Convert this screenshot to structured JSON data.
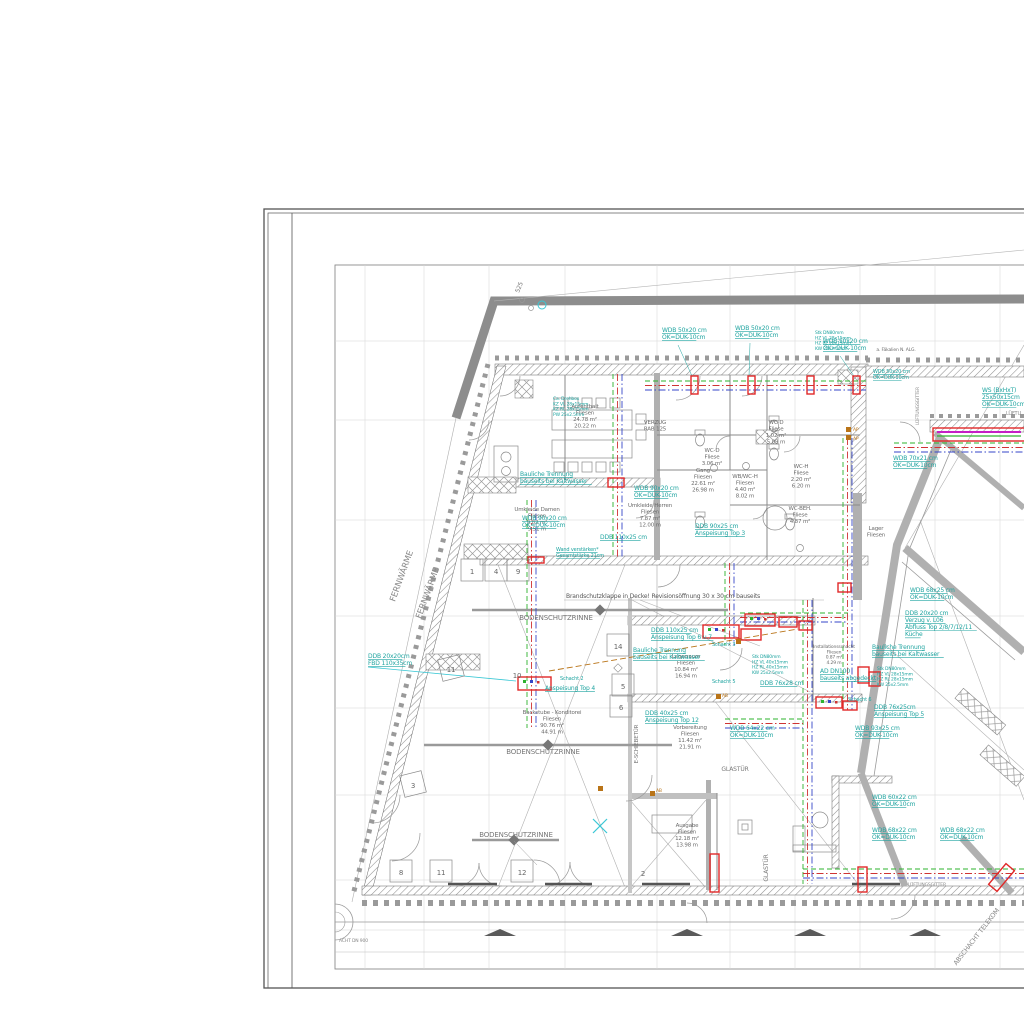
{
  "drawing": {
    "palette": {
      "annotation_teal": "#1fa4a0",
      "marker_red": "#e02828",
      "pipe_green": "#2db32d",
      "pipe_red": "#cf3333",
      "pipe_blue": "#3546c8",
      "pipe_orange": "#b97418",
      "magenta": "#c520c5",
      "wall_gray": "#b0b0b0",
      "band_gray": "#8d8d8d",
      "text_gray": "#6b6b6b",
      "cyan_light": "#39c7d4"
    },
    "annotations": [
      {
        "t": "WDB 50x20 cm\nOK=DUK-10cm",
        "x": 662,
        "y": 332,
        "u": 1
      },
      {
        "t": "WDB 50x20 cm\nOK=DUK-10cm",
        "x": 735,
        "y": 330,
        "u": 1
      },
      {
        "t": "WDB 50x20 cm\nOK=DUK-10cm",
        "x": 823,
        "y": 343,
        "u": 1
      },
      {
        "t": "WDB 50x20 cm\nOK=DUK-10cm",
        "x": 873,
        "y": 373,
        "u": 1,
        "s": 5
      },
      {
        "t": "WS (BxHxT)\n25x50x15cm\nOK=DUK-10cm",
        "x": 982,
        "y": 392,
        "u": 1
      },
      {
        "t": "WDB 70x21 cm\nOK=DUK-10cm",
        "x": 893,
        "y": 460,
        "u": 1
      },
      {
        "t": "WDB 90x20 cm\nOK=DUK-10cm",
        "x": 634,
        "y": 490,
        "u": 1
      },
      {
        "t": "WDB 90x20 cm\nOK=DUK-10cm",
        "x": 522,
        "y": 520,
        "u": 1
      },
      {
        "t": "DDB 110x25 cm",
        "x": 600,
        "y": 539,
        "u": 1
      },
      {
        "t": "DDB 90x25 cm\nAnspeisung Top 3",
        "x": 695,
        "y": 528,
        "u": 1
      },
      {
        "t": "Wand verstärken*\nGesamtstärke 21cm",
        "x": 556,
        "y": 551,
        "u": 1,
        "s": 5
      },
      {
        "t": "Ca. Drehbox\nKZ VL 28x15mm\nKZ RL 28x15mm\nPW 25x2.5mm",
        "x": 553,
        "y": 400,
        "s": 4.5
      },
      {
        "t": "Bauliche Trennung\nbauseits bei Kaltwasser",
        "x": 520,
        "y": 476,
        "u": 1
      },
      {
        "t": "Bauliche Trennung\nbauseits bei Kaltwasser",
        "x": 633,
        "y": 652,
        "u": 1
      },
      {
        "t": "Bauliche Trennung\nbauseits bei Kaltwasser",
        "x": 872,
        "y": 649,
        "u": 1
      },
      {
        "t": "DDB 20x20cm\nFBD 110x35cm",
        "x": 368,
        "y": 658,
        "u": 1
      },
      {
        "t": "Schacht 2",
        "x": 560,
        "y": 680,
        "s": 5
      },
      {
        "t": "Anspeisung Top 4",
        "x": 545,
        "y": 690,
        "u": 1
      },
      {
        "t": "DDB 110x25 cm\nAnspeisung Top 6 u.7",
        "x": 651,
        "y": 632,
        "u": 1
      },
      {
        "t": "DDB 40x25 cm\nAnspeisung Top 12",
        "x": 645,
        "y": 715,
        "u": 1
      },
      {
        "t": "WDB 64x22 cm\nOK=DUK-10cm",
        "x": 730,
        "y": 730,
        "u": 1
      },
      {
        "t": "DDB 76x28 cm",
        "x": 760,
        "y": 685,
        "u": 1
      },
      {
        "t": "DDB 20x20 cm\nVerzug v. L06\nAbfluss Top 2/8/7/12/11\nKüche",
        "x": 905,
        "y": 615,
        "u": 1
      },
      {
        "t": "WDB 68x25 cm\nOK=DUK-10cm",
        "x": 910,
        "y": 592,
        "u": 1
      },
      {
        "t": "DDB 76x25cm\nAnspeisung Top 5",
        "x": 874,
        "y": 709,
        "u": 1
      },
      {
        "t": "WDB 93x25 cm\nOK=DUK-10cm",
        "x": 855,
        "y": 730,
        "u": 1
      },
      {
        "t": "WDB 60x22 cm\nOK=DUK-10cm",
        "x": 872,
        "y": 799,
        "u": 1
      },
      {
        "t": "WDB 68x22 cm\nOK=DUK-10cm",
        "x": 872,
        "y": 832,
        "u": 1
      },
      {
        "t": "WDB 68x22 cm\nOK=DUK-10cm",
        "x": 940,
        "y": 832,
        "u": 1
      },
      {
        "t": "Schacht 3",
        "x": 712,
        "y": 646,
        "s": 5
      },
      {
        "t": "Schacht 5",
        "x": 712,
        "y": 683,
        "s": 5
      },
      {
        "t": "Schacht 6",
        "x": 848,
        "y": 701,
        "s": 5
      },
      {
        "t": "AD DN100\nbauseits abgedeckt",
        "x": 820,
        "y": 673,
        "u": 1
      },
      {
        "t": "Stk DN80mm\nHZ VL 28x15mm\nHZ RL 28x15mm\nKW 25x2.5mm",
        "x": 815,
        "y": 334,
        "s": 4.5
      },
      {
        "t": "Stk DN80mm\nHZ VL 40x15mm\nHZ RL 40x15mm\nKW 25x2.5mm",
        "x": 752,
        "y": 658,
        "s": 4.5
      },
      {
        "t": "Stk DN80mm\nHZ VL 28x15mm\nHZ RL 28x15mm\nKW 25x2.5mm",
        "x": 877,
        "y": 670,
        "s": 4.5
      }
    ],
    "rooms": [
      {
        "t": "Aufenthalt\nFliesen\n24.78 m²\n20.22 m",
        "x": 585,
        "y": 408
      },
      {
        "t": "WC-D\nFliese\n3.06 m²",
        "x": 712,
        "y": 452
      },
      {
        "t": "WC-D\nFliese\n1.02 m²\n5.09 m",
        "x": 776,
        "y": 424
      },
      {
        "t": "WB/WC-H\nFliesen\n4.40 m²\n8.02 m",
        "x": 745,
        "y": 478
      },
      {
        "t": "WC-H\nFliese\n2.20 m²\n6.20 m",
        "x": 801,
        "y": 468
      },
      {
        "t": "Gang\nFliesen\n22.61 m²\n26.98 m",
        "x": 703,
        "y": 472
      },
      {
        "t": "WC-BEH.\nFliese\n4.87 m²",
        "x": 800,
        "y": 510
      },
      {
        "t": "Lager\nFliesen",
        "x": 876,
        "y": 530
      },
      {
        "t": "Umkleide Herren\nFliesen\n7.87 m²\n12.00 m",
        "x": 650,
        "y": 507
      },
      {
        "t": "Umkleide Damen\nFliesen\n9.82 m²\n9.51 m",
        "x": 537,
        "y": 511
      },
      {
        "t": "Backstube - Konditorei\nFliesen\n90.76 m²\n44.91 m",
        "x": 552,
        "y": 714
      },
      {
        "t": "Vorbereitung\nFliesen\n11.42 m²\n21.91 m",
        "x": 690,
        "y": 729
      },
      {
        "t": "Lagerraum\nFliesen\n10.84 m²\n16.94 m",
        "x": 686,
        "y": 658
      },
      {
        "t": "Ausgabe\nFliesen\n12.18 m²\n13.98 m",
        "x": 687,
        "y": 827
      },
      {
        "t": "Installationsschacht\nFliesen\n0.87 m²\n4.29 m",
        "x": 834,
        "y": 648,
        "s": 4.5
      },
      {
        "t": "VERZUG\nRAB 125",
        "x": 655,
        "y": 424
      },
      {
        "t": "a. Fäkalien N. ALG.",
        "x": 896,
        "y": 351,
        "s": 4.5
      }
    ],
    "misc": [
      {
        "t": "FERNWÄRME",
        "x": 404,
        "y": 577,
        "r": -70,
        "s": 8.5,
        "c": "#8a8a8a",
        "a": "middle"
      },
      {
        "t": "FERNWÄRME",
        "x": 430,
        "y": 594,
        "r": -70,
        "s": 8.5,
        "c": "#8a8a8a",
        "a": "middle"
      },
      {
        "t": "BODENSCHUTZRINNE",
        "x": 556,
        "y": 620,
        "s": 7,
        "c": "#787878",
        "a": "middle"
      },
      {
        "t": "BODENSCHUTZRINNE",
        "x": 543,
        "y": 754,
        "s": 7,
        "c": "#787878",
        "a": "middle"
      },
      {
        "t": "BODENSCHUTZRINNE",
        "x": 516,
        "y": 837,
        "s": 7,
        "c": "#787878",
        "a": "middle"
      },
      {
        "t": "Brandschutzklappe in Decke! Revisionsöffnung 30 x 30 cm bauseits",
        "x": 566,
        "y": 598,
        "s": 6,
        "c": "#555555"
      },
      {
        "t": "GLASTÜR",
        "x": 735,
        "y": 771,
        "s": 6,
        "c": "#787878",
        "a": "middle"
      },
      {
        "t": "GLASTÜR",
        "x": 768,
        "y": 868,
        "r": -90,
        "s": 6,
        "c": "#787878",
        "a": "middle"
      },
      {
        "t": "E-SCHIEBETÜR",
        "x": 638,
        "y": 744,
        "r": -90,
        "s": 5.5,
        "c": "#787878",
        "a": "middle"
      },
      {
        "t": "ABSCHACHT TELEKOM",
        "x": 978,
        "y": 938,
        "r": -52,
        "s": 6.5,
        "c": "#8a8a8a",
        "a": "middle"
      },
      {
        "t": "ACHT DN 900",
        "x": 339,
        "y": 942,
        "s": 4.5,
        "c": "#888888"
      },
      {
        "t": "LÜFTUNGSGITTER",
        "x": 919,
        "y": 406,
        "r": -90,
        "s": 4.5,
        "c": "#888888",
        "a": "middle"
      },
      {
        "t": "LÜFTUNGSGITTER",
        "x": 908,
        "y": 886,
        "s": 4.5,
        "c": "#888888"
      },
      {
        "t": "LÜFTU",
        "x": 1006,
        "y": 415,
        "s": 5,
        "c": "#888888"
      },
      {
        "t": "525",
        "x": 521,
        "y": 288,
        "r": -68,
        "s": 6,
        "c": "#777777",
        "a": "middle"
      },
      {
        "t": "AP",
        "x": 853,
        "y": 431,
        "s": 4.5,
        "c": "#b97418"
      },
      {
        "t": "AP",
        "x": 853,
        "y": 440,
        "s": 4.5,
        "c": "#b97418"
      },
      {
        "t": "AB",
        "x": 656,
        "y": 792,
        "s": 4.5,
        "c": "#b97418"
      },
      {
        "t": "AB",
        "x": 722,
        "y": 697,
        "s": 4.5,
        "c": "#b97418"
      }
    ],
    "numbers": [
      {
        "t": "1",
        "x": 472,
        "y": 577,
        "b": 1
      },
      {
        "t": "4",
        "x": 496,
        "y": 577,
        "b": 1
      },
      {
        "t": "9",
        "x": 518,
        "y": 577,
        "b": 1
      },
      {
        "t": "11",
        "x": 451,
        "y": 675,
        "b": 1,
        "r": -14
      },
      {
        "t": "10",
        "x": 517,
        "y": 681
      },
      {
        "t": "14",
        "x": 618,
        "y": 652,
        "b": 1
      },
      {
        "t": "5",
        "x": 623,
        "y": 692,
        "b": 1
      },
      {
        "t": "6",
        "x": 621,
        "y": 713,
        "b": 1
      },
      {
        "t": "3",
        "x": 413,
        "y": 791,
        "b": 1,
        "r": -14
      },
      {
        "t": "8",
        "x": 401,
        "y": 878,
        "b": 1
      },
      {
        "t": "11",
        "x": 441,
        "y": 878,
        "b": 1
      },
      {
        "t": "12",
        "x": 522,
        "y": 878,
        "b": 1
      },
      {
        "t": "2",
        "x": 643,
        "y": 879
      }
    ]
  }
}
